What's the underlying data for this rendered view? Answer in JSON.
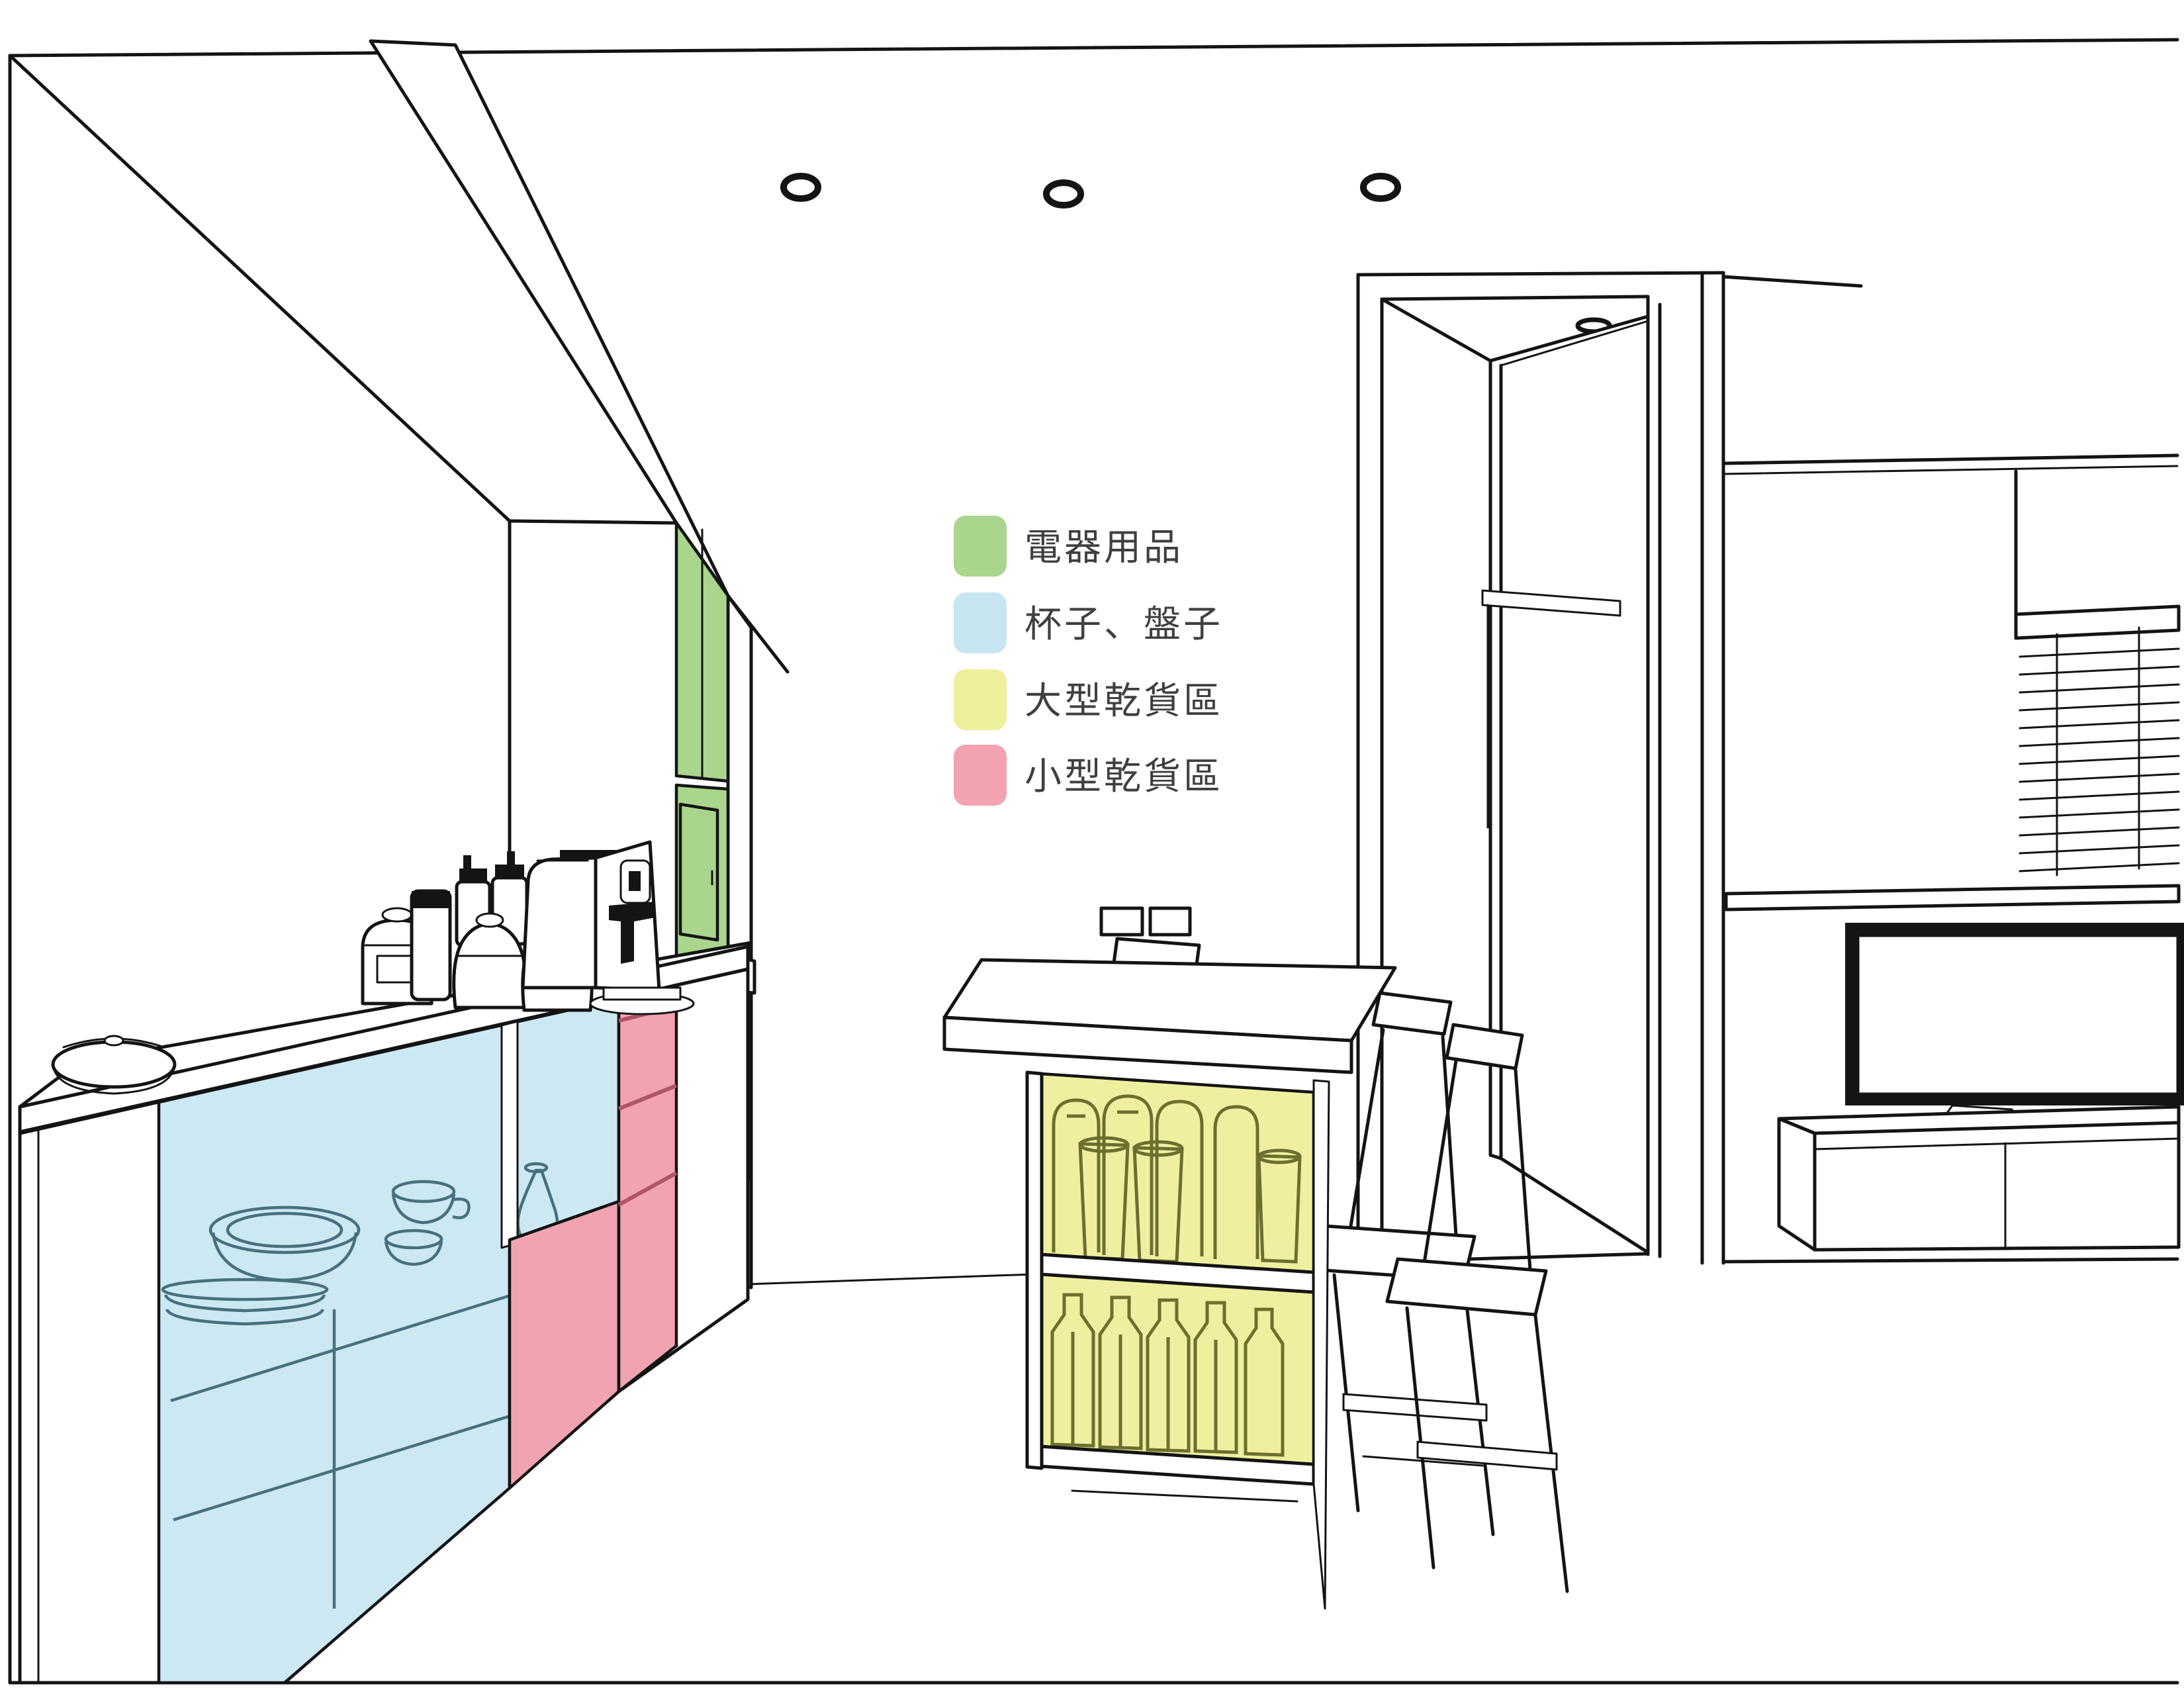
{
  "palette": {
    "green": "#a9d58d",
    "blue": "#cbe8f3",
    "yellow": "#eef0a0",
    "pink": "#f1a3b1",
    "pink_divider": "#b05468",
    "olive": "#6d6f2e",
    "dish": "#47707f",
    "line": "#141414",
    "text": "#3f3f3f",
    "wall": "#ffffff"
  },
  "legend": {
    "items": [
      {
        "id": "appliances",
        "label": "電器用品",
        "color": "#a9d58d"
      },
      {
        "id": "cups-plates",
        "label": "杯子、盤子",
        "color": "#c6e6f2"
      },
      {
        "id": "large-dry-goods",
        "label": "大型乾貨區",
        "color": "#eef09b"
      },
      {
        "id": "small-dry-goods",
        "label": "小型乾貨區",
        "color": "#f2a2b0"
      }
    ]
  }
}
